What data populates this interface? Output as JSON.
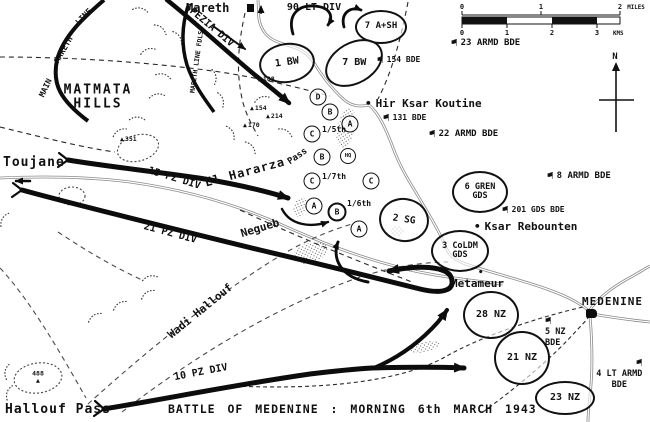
{
  "caption": "BATTLE OF MEDENINE : MORNING 6th MARCH 1943",
  "north": "N",
  "icons": {
    "flag": "⚑",
    "dot": "•",
    "hill": "▲"
  },
  "colors": {
    "ink": "#111111",
    "road_gray": "#8a8a8a",
    "paper": "#ffffff"
  },
  "scale": {
    "miles": [
      "0",
      "1",
      "2"
    ],
    "miles_unit": "MILES",
    "kms": [
      "0",
      "1",
      "2",
      "3"
    ],
    "kms_unit": "KMS"
  },
  "towns": {
    "mareth": "Mareth",
    "toujane": "Toujane",
    "metameur": "Metameur",
    "medenine": "MEDENINE",
    "hir_ksar_koutine": "Hir Ksar Koutine",
    "ksar_rebounten": "Ksar Rebounten",
    "hallouf_pass": "Hallouf Pass"
  },
  "regions": {
    "matmata1": "MATMATA",
    "matmata2": "HILLS",
    "main1": "MAIN",
    "main2": "MARETH",
    "main3": "LINE",
    "fdls": "MARETH LINE FDLS",
    "wadi": "Wadi Hallouf",
    "el_hararza": "El Hararza",
    "pass": "Pass",
    "negueb": "Negueb"
  },
  "axes": {
    "spezia": "SPEZIA DIV",
    "lt90": "90 LT DIV",
    "pz15": "15 PZ DIV",
    "pz21": "21 PZ DIV",
    "pz10": "10 PZ DIV"
  },
  "units": {
    "ash7": "7 A+SH",
    "bw1": "1 BW",
    "bw7": "7 BW",
    "sg2": "2 SG",
    "gren1": "6 GREN",
    "gren2": "GDS",
    "coldm1": "3 CoLDM",
    "coldm2": "GDS",
    "nz28": "28 NZ",
    "nz21": "21 NZ",
    "nz23": "23 NZ"
  },
  "companies": {
    "d": "D",
    "b1": "B",
    "a1": "A",
    "c1": "C",
    "b2": "B",
    "hq": "HQ",
    "c2": "C",
    "c3": "C",
    "a2": "A",
    "b3": "B",
    "a3": "A",
    "s15": "1/5th",
    "s17": "1/7th",
    "s16": "1/6th"
  },
  "flags": {
    "f23": "23 ARMD BDE",
    "f154": "154 BDE",
    "f131": "131 BDE",
    "f22": "22 ARMD BDE",
    "f8": "8 ARMD BDE",
    "f201": "201 GDS BDE",
    "f5a": "5 NZ",
    "f5b": "BDE",
    "f4a": "4 LT ARMD",
    "f4b": "BDE"
  },
  "hills": {
    "h351": "351",
    "h214": "214",
    "h154": "154",
    "h170": "170",
    "h188": "188",
    "h488": "488"
  }
}
